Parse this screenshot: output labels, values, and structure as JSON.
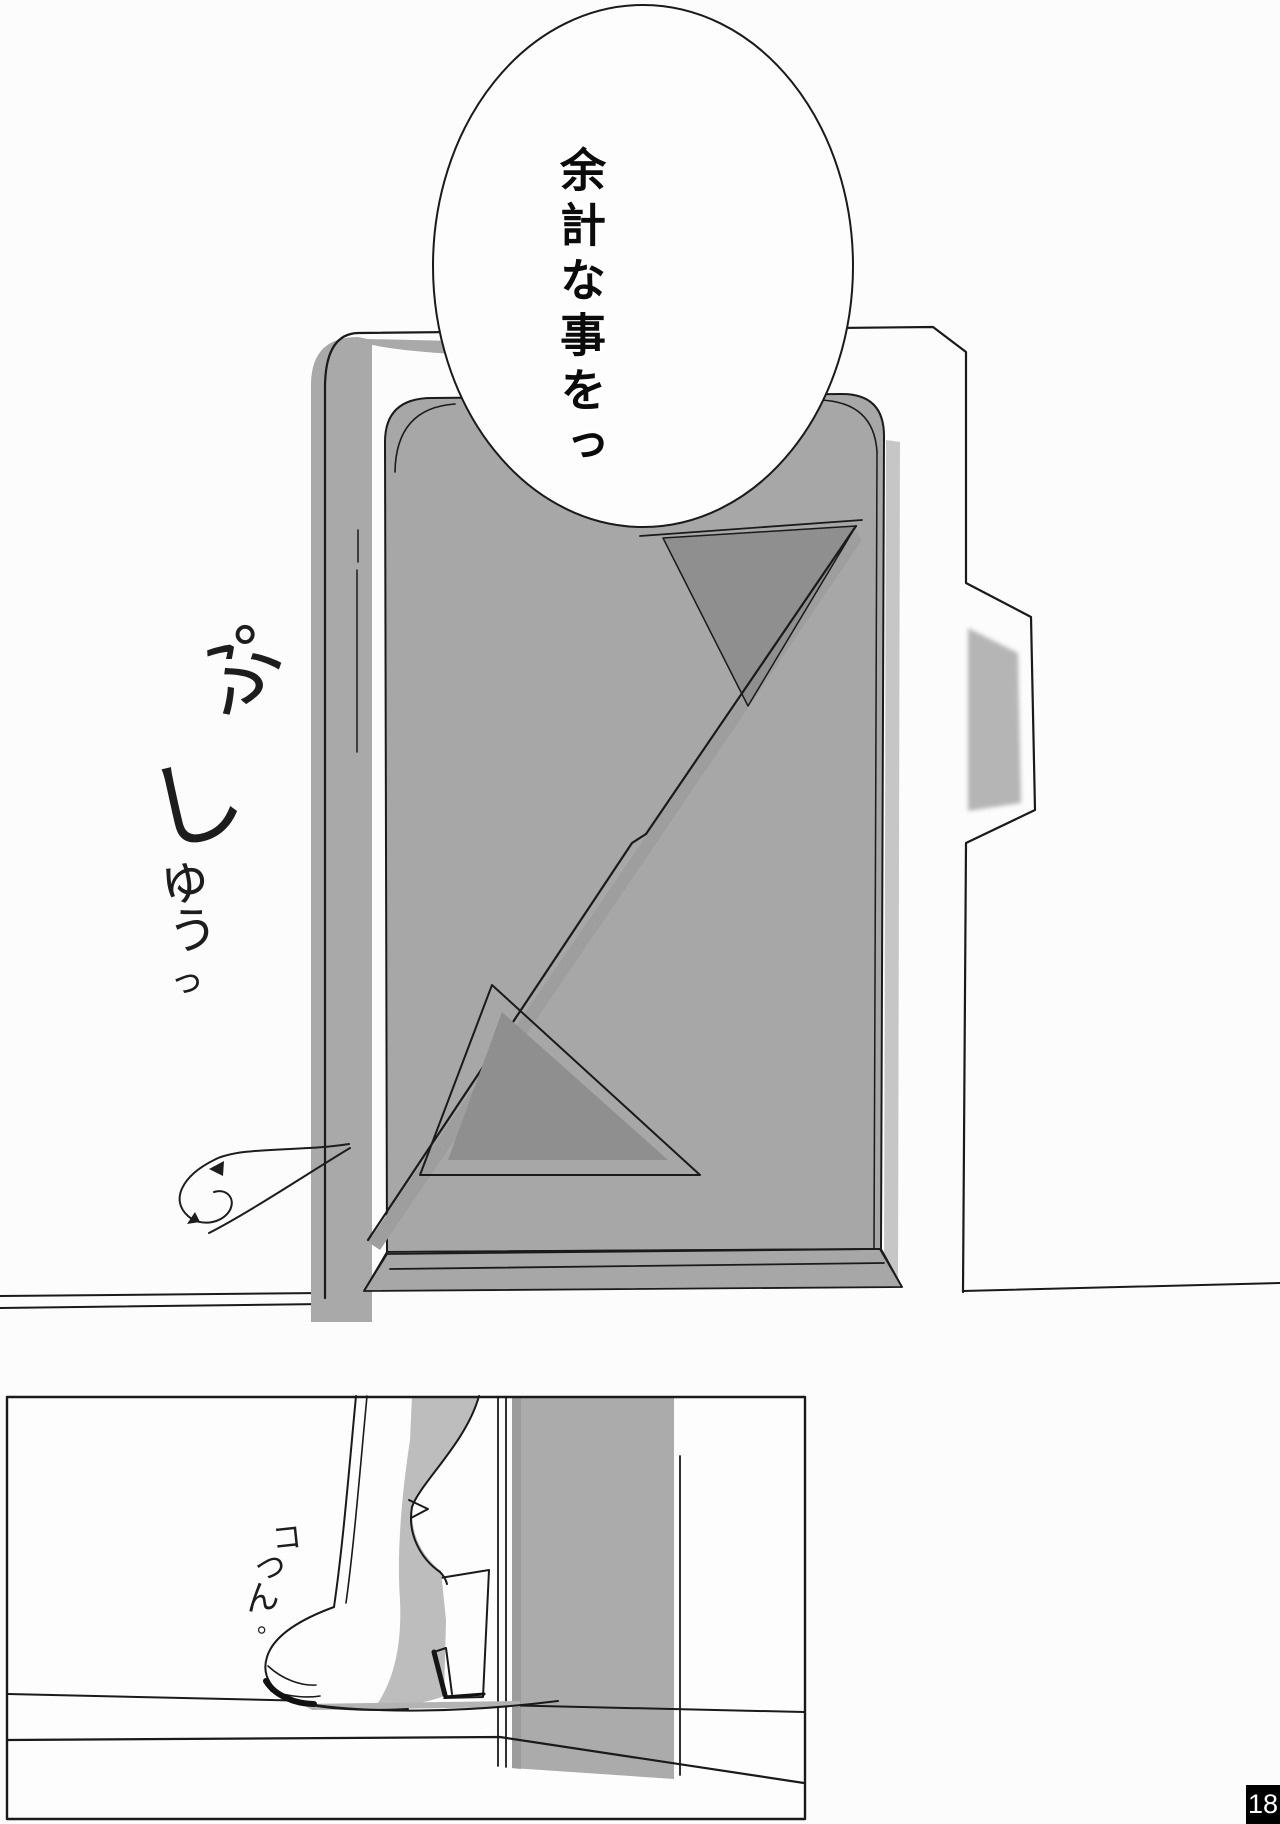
{
  "page": {
    "number": "18"
  },
  "panels": {
    "top": {
      "speech_bubble_text": "余計な事をっ",
      "sfx_text": "ぷしゅうっ",
      "sfx_chars": [
        "ぷ",
        "し",
        "ゅ",
        "う",
        "っ"
      ]
    },
    "bottom": {
      "sfx_text": "コつん。",
      "sfx_chars": [
        "コ",
        "つ",
        "ん",
        "。"
      ]
    }
  },
  "colors": {
    "line": "#1a1a1a",
    "paper": "#fcfcfc",
    "door_gray": "#a7a7a7",
    "frame_shadow_gray": "#a9a9a9",
    "design_dark_gray": "#8f8f8f",
    "diagonal_band_gray": "#9e9e9e",
    "tab_recess_gray": "#b5b5b5",
    "bottom_wall_gray": "#ababab",
    "boot_shade_gray": "#bdbdbd",
    "pagenum_bg": "#000000",
    "pagenum_fg": "#ffffff"
  }
}
